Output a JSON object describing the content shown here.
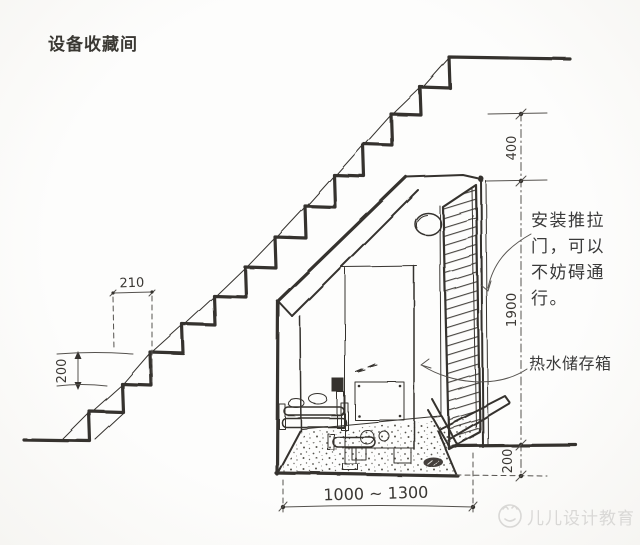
{
  "title": "设备收藏间",
  "notes": {
    "door_line1": "安装推拉",
    "door_line2": "门，可以",
    "door_line3": "不妨碍通",
    "door_line4": "行。",
    "door_note_full": "安装推拉门，可以不妨碍通行。",
    "tank_label": "热水储存箱"
  },
  "dimensions": {
    "tread_depth": "210",
    "riser_height": "200",
    "top_rise": "400",
    "closet_height": "1900",
    "base_height": "200",
    "width_range": "1000 ~ 1300"
  },
  "watermark": {
    "text": "儿儿设计教育",
    "logo": "smiley-circle-logo"
  },
  "colors": {
    "ink": "#35322e",
    "dim_line": "#55524e",
    "paper": "#fbfaf8",
    "watermark": "#d9d8d6"
  }
}
